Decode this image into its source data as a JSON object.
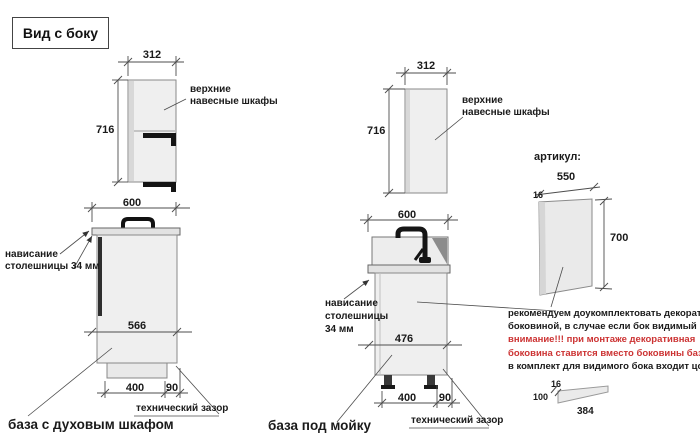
{
  "title": "Вид с боку",
  "left": {
    "upper": {
      "width": "312",
      "height": "716",
      "label": "верхние навесные шкафы"
    },
    "base": {
      "width": "600",
      "depth": "566",
      "plinth_len": "400",
      "gap": "90",
      "overhang_lines": [
        "нависание",
        "столешницы 34 мм"
      ],
      "gap_label": "технический зазор",
      "caption": "база с духовым шкафом"
    }
  },
  "middle": {
    "upper": {
      "width": "312",
      "height": "716",
      "label": "верхние навесные шкафы"
    },
    "base": {
      "width": "600",
      "depth": "476",
      "plinth_len": "400",
      "gap": "90",
      "overhang_lines": [
        "нависание",
        "столешницы",
        "34 мм"
      ],
      "gap_label": "технический зазор",
      "caption": "база под мойку"
    }
  },
  "right": {
    "header": "артикул:",
    "panel": {
      "width": "550",
      "thickness": "16",
      "height": "700"
    },
    "note_lines": [
      {
        "text": "рекомендуем доукомплектовать декоративной",
        "color": "black"
      },
      {
        "text": "боковиной, в случае если бок видимый",
        "color": "black"
      },
      {
        "text": "внимание!!! при монтаже декоративная",
        "color": "red"
      },
      {
        "text": "боковина ставится вместо боковины базы лдсп",
        "color": "red"
      },
      {
        "text": "в комплект для видимого бока входит цоколь:",
        "color": "black"
      }
    ],
    "plinth": {
      "thickness": "16",
      "height": "100",
      "length": "384"
    }
  },
  "colors": {
    "red": "#cc3333",
    "line": "#4d4d4d",
    "cabinet_fill": "#efefef",
    "dark": "#1a1a1a"
  }
}
